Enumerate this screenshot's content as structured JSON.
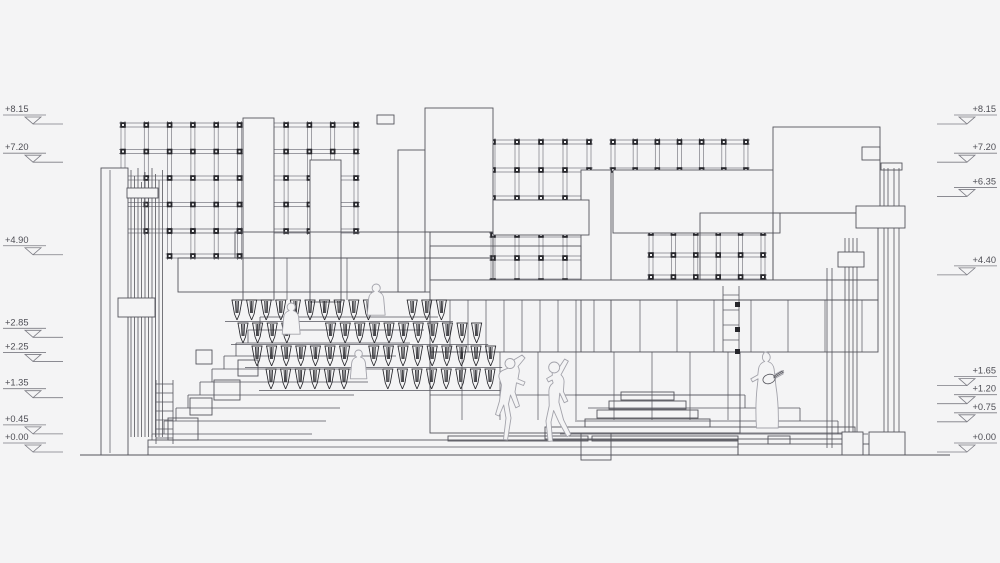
{
  "levels": {
    "zero_y": 452,
    "px_per_m": 40.25,
    "left": [
      "+8.15",
      "+7.20",
      "+4.90",
      "+2.85",
      "+2.25",
      "+1.35",
      "+0.45",
      "+0.00"
    ],
    "right": [
      "+8.15",
      "+7.20",
      "+6.35",
      "+4.40",
      "+1.65",
      "+1.20",
      "+0.75",
      "+0.00"
    ]
  },
  "palette": {
    "bg": "#f4f4f5",
    "line": "#55555c",
    "dark": "#26262b",
    "faint": "#7c7c84",
    "figure": "#a3a3ab"
  },
  "ground": [
    80,
    455,
    950,
    455
  ],
  "grids": [
    {
      "name": "pergola-grid-left",
      "x": 123,
      "y": 125,
      "nc": 11,
      "nr": 5,
      "cw": 23.3,
      "ch": 26.5
    },
    {
      "name": "pergola-grid-left-extension",
      "x": 169.6,
      "y": 231,
      "nc": 4,
      "nr": 2,
      "cw": 23.3,
      "ch": 25
    },
    {
      "name": "pergola-grid-center-upper",
      "x": 493,
      "y": 142,
      "nc": 5,
      "nr": 3,
      "cw": 24,
      "ch": 28
    },
    {
      "name": "pergola-grid-center-lower",
      "x": 493,
      "y": 235,
      "nc": 5,
      "nr": 3,
      "cw": 24,
      "ch": 23
    },
    {
      "name": "pergola-grid-right",
      "x": 651,
      "y": 233,
      "nc": 6,
      "nr": 3,
      "cw": 22.4,
      "ch": 22
    },
    {
      "name": "pergola-post-strip",
      "x": 613,
      "y": 142,
      "nc": 7,
      "nr": 2,
      "cw": 22.16,
      "ch": 28
    }
  ],
  "rects_mask": [
    [
      243,
      118,
      31,
      182,
      1
    ],
    [
      310,
      160,
      31,
      142,
      1
    ],
    [
      398,
      150,
      27,
      142,
      1
    ],
    [
      425,
      108,
      68,
      124,
      1
    ],
    [
      581,
      170,
      30,
      290,
      1
    ],
    [
      613,
      170,
      167,
      63,
      1
    ],
    [
      773,
      127,
      107,
      86,
      1
    ],
    [
      862,
      147,
      18,
      13,
      0
    ],
    [
      493,
      200,
      96,
      35,
      1
    ]
  ],
  "cluster": {
    "xs": [
      131,
      134.5,
      138,
      141.5,
      145,
      148.5,
      152,
      155.5,
      159,
      162.5
    ],
    "tops": [
      170,
      176,
      168,
      182,
      172,
      178,
      168,
      174,
      180,
      170
    ],
    "bottom": 437
  },
  "rects_struct": [
    [
      101,
      168,
      27,
      287,
      1
    ],
    [
      118,
      298,
      37,
      19,
      1
    ],
    [
      127,
      188,
      31,
      10,
      1
    ],
    [
      235,
      232,
      258,
      26,
      0
    ],
    [
      178,
      258,
      315,
      34,
      0
    ],
    [
      430,
      232,
      63,
      48,
      0
    ],
    [
      430,
      246,
      151,
      34,
      0
    ],
    [
      700,
      213,
      73,
      67,
      0
    ],
    [
      773,
      213,
      105,
      67,
      0
    ],
    [
      430,
      280,
      448,
      20,
      1
    ],
    [
      430,
      300,
      448,
      52,
      0
    ],
    [
      430,
      352,
      310,
      81,
      1
    ],
    [
      377,
      115,
      17,
      9,
      0
    ],
    [
      545,
      427,
      310,
      12,
      0
    ],
    [
      585,
      419,
      125,
      8,
      0
    ],
    [
      597,
      410,
      101,
      8,
      0
    ],
    [
      609,
      401,
      77,
      8,
      0
    ],
    [
      621,
      392,
      53,
      8,
      0
    ],
    [
      168,
      418,
      30,
      22,
      0
    ],
    [
      190,
      398,
      22,
      17,
      0
    ],
    [
      214,
      380,
      26,
      20,
      0
    ],
    [
      196,
      350,
      16,
      14,
      0
    ],
    [
      238,
      360,
      20,
      16,
      0
    ],
    [
      448,
      436,
      140,
      5,
      0
    ],
    [
      592,
      436,
      146,
      5,
      0
    ],
    [
      148,
      440,
      590,
      15,
      0
    ],
    [
      738,
      444,
      132,
      11,
      0
    ],
    [
      768,
      436,
      22,
      8,
      0
    ],
    [
      881,
      163,
      21,
      7,
      0
    ]
  ],
  "wall_lines": [
    [
      110,
      170,
      110,
      453
    ],
    [
      287,
      258,
      287,
      300
    ],
    [
      347,
      258,
      347,
      300
    ],
    [
      462,
      352,
      462,
      420
    ],
    [
      500,
      352,
      500,
      420
    ],
    [
      538,
      352,
      538,
      420
    ],
    [
      576,
      352,
      576,
      420
    ],
    [
      614,
      352,
      614,
      420
    ],
    [
      652,
      352,
      652,
      420
    ],
    [
      690,
      352,
      690,
      420
    ],
    [
      728,
      352,
      728,
      420
    ],
    [
      430,
      395,
      740,
      395
    ],
    [
      450,
      300,
      450,
      352
    ],
    [
      468,
      300,
      468,
      352
    ],
    [
      486,
      300,
      486,
      352
    ],
    [
      504,
      300,
      504,
      352
    ],
    [
      522,
      300,
      522,
      352
    ],
    [
      540,
      300,
      540,
      352
    ],
    [
      558,
      300,
      558,
      352
    ],
    [
      576,
      300,
      576,
      352
    ],
    [
      594,
      300,
      594,
      352
    ],
    [
      640,
      300,
      640,
      352
    ],
    [
      677,
      300,
      677,
      352
    ],
    [
      714,
      300,
      714,
      352
    ],
    [
      751,
      300,
      751,
      352
    ],
    [
      788,
      300,
      788,
      352
    ],
    [
      825,
      300,
      825,
      352
    ],
    [
      862,
      300,
      862,
      352
    ],
    [
      545,
      433,
      855,
      433
    ],
    [
      148,
      447,
      738,
      447
    ]
  ],
  "posts": [
    {
      "xs": [
        827,
        832
      ],
      "y1": 268,
      "y2": 448
    },
    {
      "xs": [
        845,
        849,
        853,
        857
      ],
      "y1": 238,
      "y2": 440
    },
    {
      "xs": [
        884,
        888,
        894,
        899
      ],
      "y1": 168,
      "y2": 432
    }
  ],
  "rects_post": [
    [
      856,
      206,
      49,
      22,
      1
    ],
    [
      838,
      252,
      26,
      15,
      1
    ],
    [
      842,
      432,
      21,
      23,
      1
    ],
    [
      869,
      432,
      36,
      23,
      1
    ]
  ],
  "ladders": [
    {
      "name": "ladder-left",
      "x1": 156,
      "x2": 173,
      "y1": 380,
      "y2": 444,
      "rungs": [
        384,
        393,
        402,
        411,
        420,
        429,
        438
      ],
      "nodes": []
    },
    {
      "name": "ladder-middle",
      "x1": 723,
      "x2": 739,
      "y1": 286,
      "y2": 352,
      "rungs": [
        295,
        310,
        325,
        340,
        352
      ],
      "nodes": [
        [
          735,
          302
        ],
        [
          735,
          327
        ],
        [
          735,
          349
        ]
      ]
    }
  ],
  "steps_left": {
    "n": 10,
    "y0": 434,
    "dy": 13,
    "x0": 152,
    "dx": 12,
    "xr0": 312,
    "dxr": 14
  },
  "steps_right_lines": [
    [
      575,
      395,
      745,
      395
    ],
    [
      745,
      395,
      745,
      408
    ],
    [
      588,
      408,
      800,
      408
    ],
    [
      800,
      408,
      800,
      421
    ],
    [
      575,
      421,
      838,
      421
    ],
    [
      838,
      421,
      838,
      434
    ],
    [
      560,
      434,
      868,
      434
    ]
  ],
  "seat_pitch": 14.6,
  "seat_rows": [
    {
      "x": 230,
      "y": 300,
      "n": 15,
      "skip": [
        10,
        11
      ]
    },
    {
      "x": 236,
      "y": 323,
      "n": 17,
      "skip": [
        4,
        5
      ]
    },
    {
      "x": 250,
      "y": 346,
      "n": 17,
      "skip": [
        7
      ]
    },
    {
      "x": 264,
      "y": 369,
      "n": 16,
      "skip": [
        6,
        7
      ]
    }
  ],
  "figures": [
    {
      "name": "seated-visitor-figure",
      "x": 368,
      "y": 284,
      "s": 0.78,
      "path": "M10.5,0c2.9,0,5.2,2.3,5.2,5.2c0,1.9-1,3.6-2.6,4.5c3.9,1.2,6.7,4.6,7,8.8L22,40H-1l1.9-21.5c0.3-4.2,3.1-7.6,7-8.8C6.3,8.8,5.3,7.1,5.3,5.2C5.3,2.3,7.6,0,10.5,0z"
    },
    {
      "name": "seated-visitor-figure-2",
      "x": 283,
      "y": 303,
      "s": 0.78,
      "path": "M10.5,0c2.9,0,5.2,2.3,5.2,5.2c0,1.9-1,3.6-2.6,4.5c3.9,1.2,6.7,4.6,7,8.8L22,40H-1l1.9-21.5c0.3-4.2,3.1-7.6,7-8.8C6.3,8.8,5.3,7.1,5.3,5.2C5.3,2.3,7.6,0,10.5,0z"
    },
    {
      "name": "seated-visitor-figure-3",
      "x": 351,
      "y": 350,
      "s": 0.72,
      "path": "M10.5,0c2.9,0,5.2,2.3,5.2,5.2c0,1.9-1,3.6-2.6,4.5c3.9,1.2,6.7,4.6,7,8.8L22,40H-1l1.9-21.5c0.3-4.2,3.1-7.6,7-8.8C6.3,8.8,5.3,7.1,5.3,5.2C5.3,2.3,7.6,0,10.5,0z"
    },
    {
      "name": "dancing-figure-left",
      "x": 494,
      "y": 354,
      "s": 1,
      "head": [
        16,
        9.5,
        5
      ],
      "path": "M28,1l3,3l-7,8.5c1,1.6,1.5,3.5,1.2,5.4L24,25l7,3l-1.5,3.5l-7-2.7L21,38l4.5,14l-3.7,1.8L16.5,41l-2,9l2.5,14l-3.5,22l-4-0.5l2.5-21.5L9.7,51L5,62l-3.5-1.5L5.5,47l2-16l-2.3-7c-1-3,0.4-6.4,3.4-7.6l5.4-2.2l6.5-8.7L28,1z"
    },
    {
      "name": "dancing-figure-right",
      "x": 530,
      "y": 358,
      "s": 1.05,
      "head": [
        23,
        9,
        5.2
      ],
      "path": "M33,1l3.5,2l-7,13c2,1.8,3.1,4.5,2.9,7.3L31.8,32l4.2,9l-3.4,1.6l-4.3-9.1l-0.8,8.5L32,59l7,14l-3.7,2L27.5,61l-5-11l-2.5,11l1.5,18l-4.2,0.5L15.2,60l3.1-14.5l-0.3-13c-0.2-3.5,1.3-6.8,4-8.8l-0.8-2.7l-3.7,1.8l-1.7-3.2l5.5-3.2L21,13l5-1.5L33,1z"
    },
    {
      "name": "guitar-player-figure",
      "x": 748,
      "y": 352,
      "s": 1,
      "guitar": true,
      "path": "M17,0c2.9,0,5.2,2.3,5.2,5.2c0,1.8-0.9,3.4-2.3,4.3c3.4,1.1,5.8,4,6.2,7.6l0.6,5.4l6.8-3.7l1.7,3.1l-8,4.4l0.6,6.7c2,12.5,3,27,2.4,43H8.5C7.4,60,7.9,45.5,9.4,33l0.7-6.2l-5.6,3.1l-1.7-3.1l7-3.9l0.7-5.8c0.4-3.6,2.8-6.5,6.2-7.6c-1.4-0.9-2.3-2.5-2.3-4.3C14.4,2.3,16.7,0,17,0z"
    }
  ]
}
